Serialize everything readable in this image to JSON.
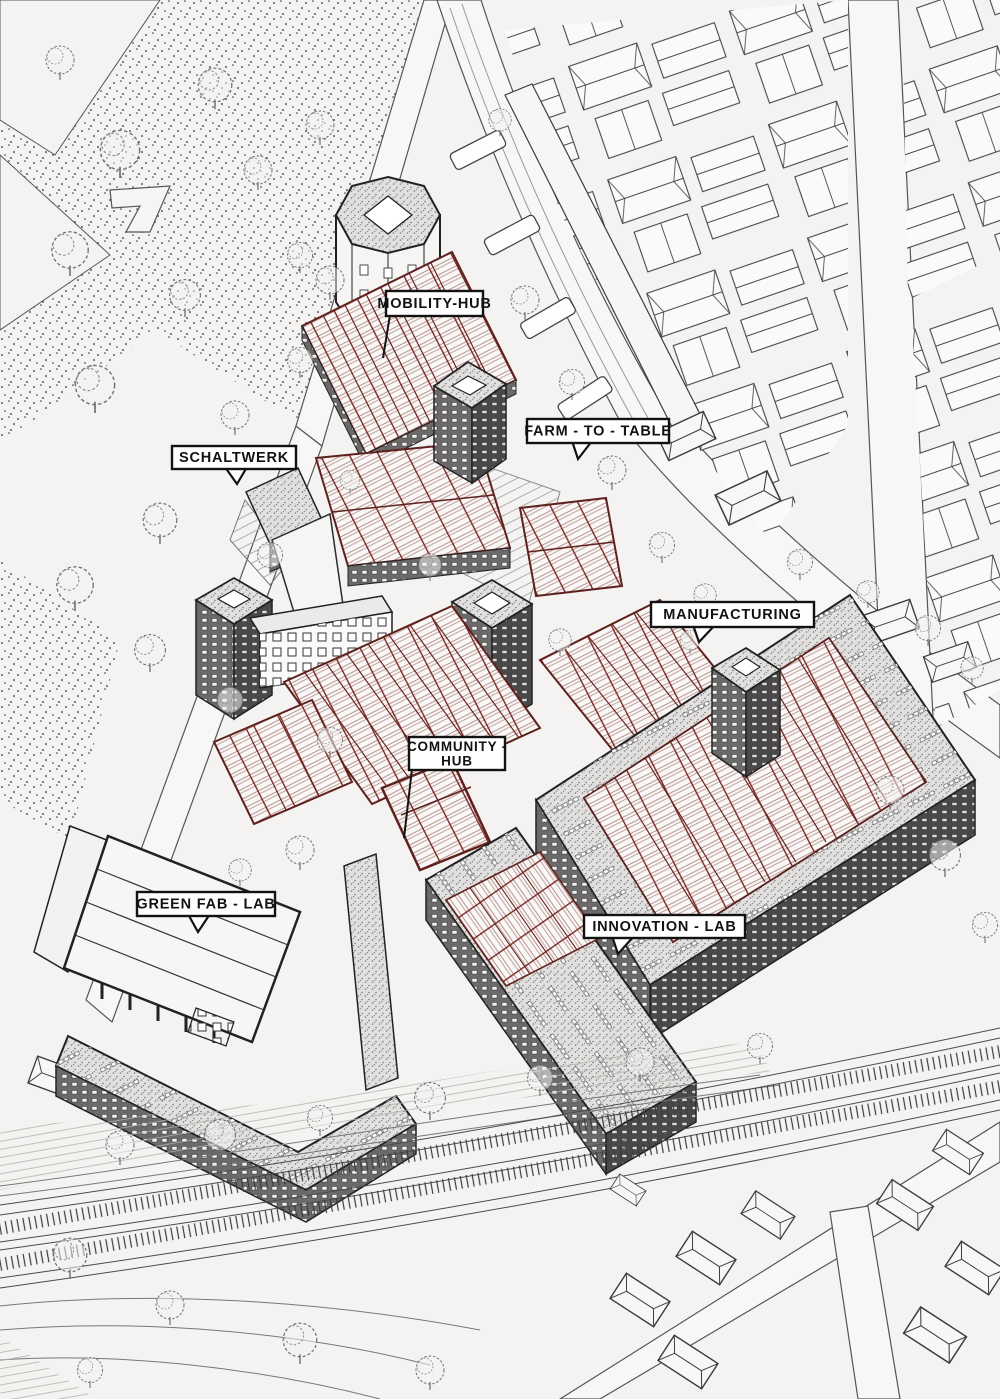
{
  "drawing": {
    "type": "axonometric-masterplan-illustration",
    "labels": {
      "mobility_hub": {
        "text": "MOBILITY-HUB"
      },
      "farm_to_table": {
        "text": "FARM - TO - TABLE"
      },
      "schaltwerk": {
        "text": "SCHALTWERK"
      },
      "manufacturing": {
        "text": "MANUFACTURING"
      },
      "community_hub": {
        "line1": "COMMUNITY -",
        "line2": "HUB"
      },
      "green_fab_lab": {
        "text": "GREEN FAB - LAB"
      },
      "innovation_lab": {
        "text": "INNOVATION - LAB"
      }
    },
    "colors": {
      "paper": "#f4f3f1",
      "ink": "#2b2b2b",
      "light_ink": "#8f8f8f",
      "intervention_outline_red": "#5f211d",
      "intervention_hatch_red": "#b09090",
      "label_background": "#ffffff",
      "label_border": "#121212",
      "label_text": "#121212"
    }
  }
}
